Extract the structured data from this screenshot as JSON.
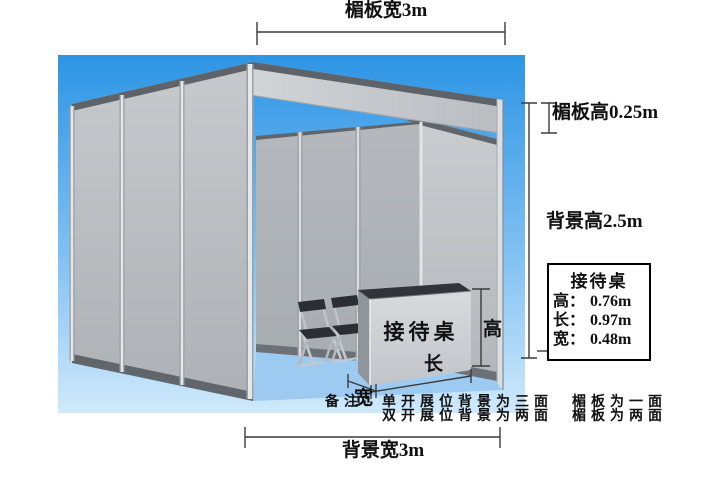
{
  "diagram": {
    "fascia_width_label": "楣板宽3m",
    "fascia_height_label": "楣板高0.25m",
    "backwall_height_label": "背景高2.5m",
    "backwall_width_label": "背景宽3m",
    "desk_front_label": "接待桌",
    "desk_height_label": "高",
    "desk_length_label": "长",
    "desk_width_label": "宽"
  },
  "info_box": {
    "title": "接待桌",
    "rows": [
      {
        "label": "高：",
        "value": "0.76m"
      },
      {
        "label": "长：",
        "value": "0.97m"
      },
      {
        "label": "宽：",
        "value": "0.48m"
      }
    ]
  },
  "notes": {
    "line1": "备注：单开展位背景为三面　楣板为一面",
    "line2": "双开展位背景为两面　楣板为两面"
  },
  "colors": {
    "sky_top": "#2d95e5",
    "sky_bottom": "#cfe9fb",
    "floor": "#9ccaf0",
    "wall_panel": "#b8bcc0",
    "wall_rail": "#5d6368",
    "desk_top": "#313539",
    "dimension_line": "#3b3b3b",
    "text": "#111111"
  }
}
